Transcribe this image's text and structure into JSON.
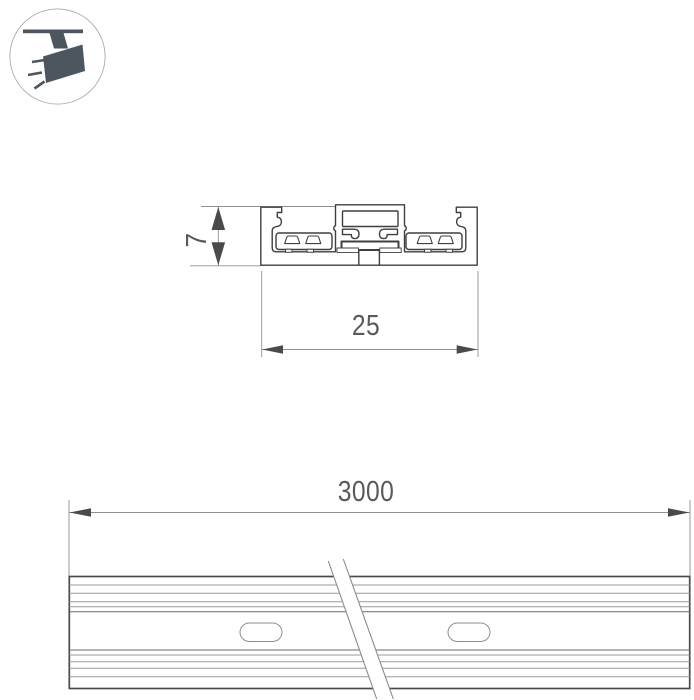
{
  "page": {
    "background_color": "#ffffff",
    "description_labels_visible": [
      "7",
      "25",
      "3000"
    ]
  },
  "icon": {
    "name": "ceiling-track-spotlight",
    "glyph_color": "#4d565e",
    "circle_border_color": "#a6abaf",
    "circle_fill": "#ffffff"
  },
  "drawing": {
    "outline_color": "#3f3f3f",
    "thin_line_color": "#8f8f8f",
    "arrow_color": "#4a4a4a",
    "label_color": "#5a5a5a",
    "cross_section": {
      "height_label": "7",
      "width_label": "25"
    },
    "rail": {
      "length_label": "3000",
      "mounting_slot_count": 2
    }
  }
}
